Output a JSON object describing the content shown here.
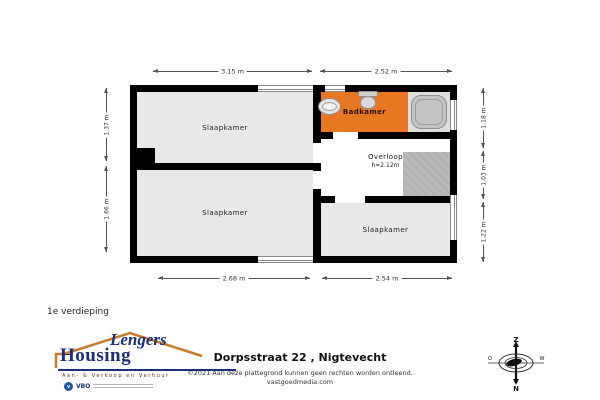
{
  "plan": {
    "rooms": [
      {
        "id": "slaapkamer-top-left",
        "label": "Slaapkamer"
      },
      {
        "id": "badkamer",
        "label": "Badkamer"
      },
      {
        "id": "overloop",
        "label": "Overloop",
        "sub": "h=2.12m"
      },
      {
        "id": "slaapkamer-bottom-left",
        "label": "Slaapkamer"
      },
      {
        "id": "slaapkamer-bottom-right",
        "label": "Slaapkamer"
      }
    ],
    "dimensions": {
      "top": [
        "3.15 m",
        "2.52 m"
      ],
      "bottom": [
        "2.68 m",
        "2.54 m"
      ],
      "left": [
        "1.37 m",
        "1.66 m"
      ],
      "right": [
        "1.18 m",
        "1.03 m",
        "1.22 m"
      ]
    },
    "fixtures": [
      "bathtub",
      "toilet",
      "sink",
      "stairs"
    ]
  },
  "floor_label": "1e verdieping",
  "logo": {
    "script": "Lengers",
    "name": "Housing",
    "tagline": "Aan- & Verkoop en Verhuur",
    "badge": "VBO"
  },
  "footer": {
    "address": "Dorpsstraat 22 , Nigtevecht",
    "copyright": "©2021  Aan deze plattegrond kunnen geen rechten worden ontleend.",
    "site": "vastgoedmedia.com"
  },
  "compass": {
    "top": "Z",
    "bottom": "N",
    "left": "O",
    "right": "W"
  },
  "colors": {
    "badkamer_highlight": "#e87722",
    "room_fill": "#e8e8e8",
    "wall": "#000000",
    "stairs": "#b8b8b8",
    "logo_navy": "#1b2f7e",
    "roof_orange": "#c97b2d"
  }
}
